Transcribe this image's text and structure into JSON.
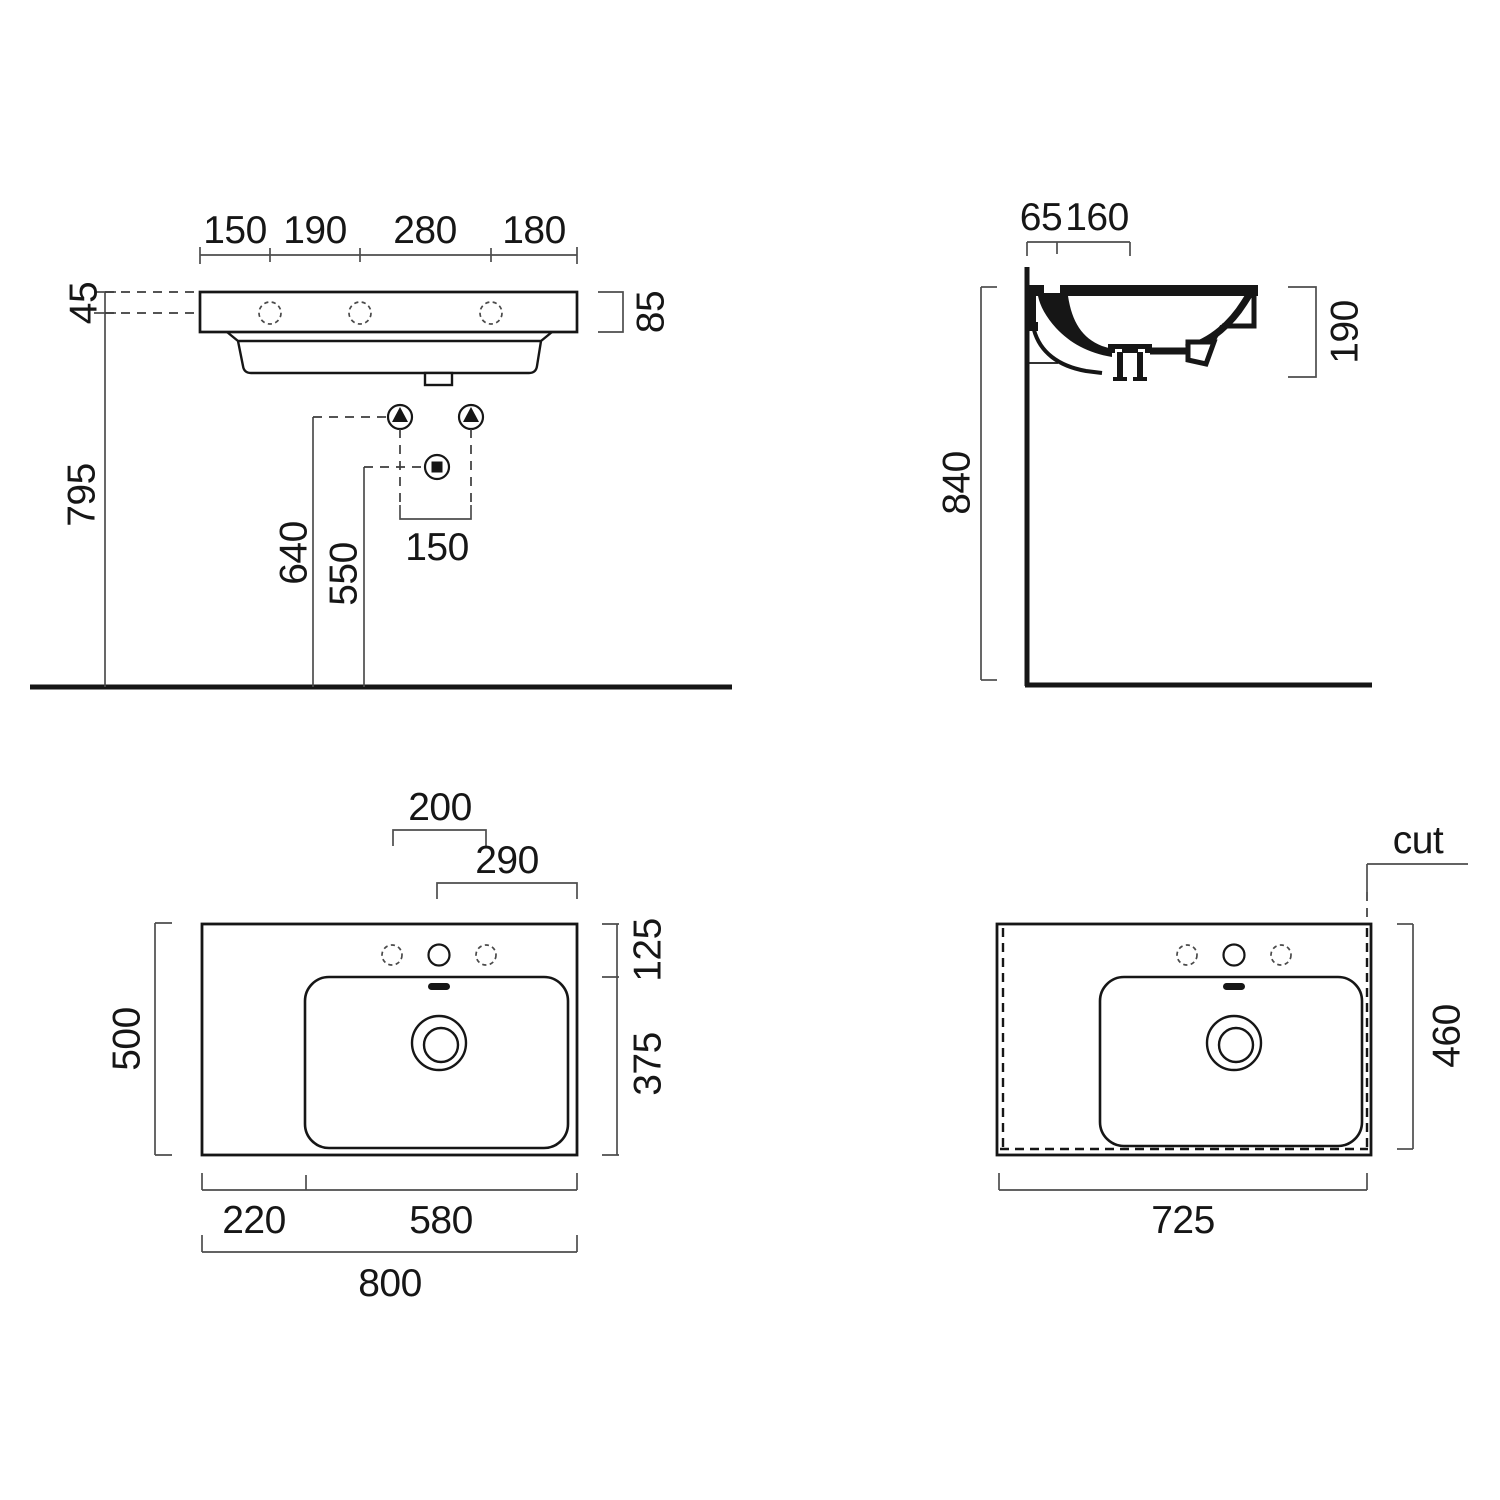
{
  "views": {
    "front": {
      "dims": {
        "chain": [
          "150",
          "190",
          "280",
          "180"
        ],
        "rim_to_holes": "45",
        "holes_to_floor": "795",
        "rim_height": "85",
        "fixing_height": "640",
        "drain_height": "550",
        "fixing_spacing": "150"
      }
    },
    "side": {
      "dims": {
        "chain": [
          "65",
          "160"
        ],
        "basin_depth": "190",
        "rim_to_floor": "840"
      }
    },
    "plan": {
      "dims": {
        "tap_hole_span": "200",
        "tap_to_edge": "290",
        "back_ledge": "125",
        "bowl_depth": "375",
        "overall_depth": "500",
        "left_ledge": "220",
        "bowl_width": "580",
        "overall_width": "800"
      }
    },
    "plan_cut": {
      "cut_label": "cut",
      "dims": {
        "cut_depth": "460",
        "cut_width": "725"
      }
    }
  }
}
